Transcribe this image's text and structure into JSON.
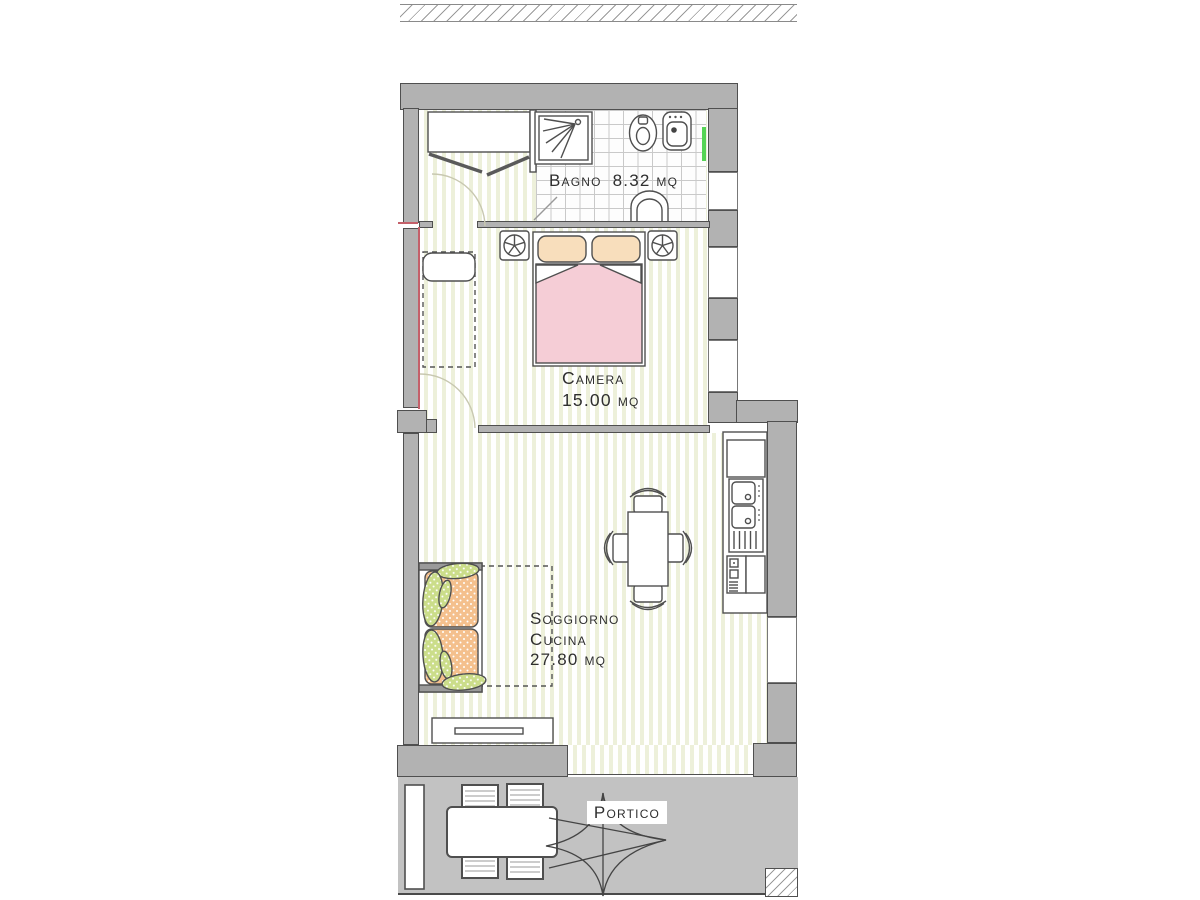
{
  "meta": {
    "drawing_type": "apartment floor plan",
    "language": "Italian"
  },
  "rooms": {
    "bathroom": {
      "label": "Bagno",
      "area": "8.32 mq"
    },
    "bedroom": {
      "label": "Camera",
      "area": "15.00 mq"
    },
    "living_kitchen": {
      "line1": "Soggiorno",
      "line2": "Cucina",
      "area": "27.80 mq"
    },
    "porch": {
      "label": "Portico"
    }
  },
  "furniture": [
    "wardrobe",
    "entry-door-swing",
    "bedroom-door-swing",
    "bathroom-door-leaf",
    "lounge-chair",
    "double-bed",
    "pillows",
    "nightstand-left",
    "nightstand-right",
    "shower",
    "toilet",
    "bidet",
    "washbasin",
    "sofa",
    "rug",
    "dining-table",
    "dining-chairs",
    "kitchen-counter",
    "kitchen-sink",
    "kitchen-appliances",
    "tv-cabinet",
    "porch-pillar",
    "porch-table",
    "porch-chairs",
    "compass-star",
    "hatched-pillar",
    "hatched-boundary-strip"
  ],
  "colors": {
    "wall": "#b2b2b2",
    "porch_floor": "#c2c2c2",
    "floor_stripe": "#edf0da",
    "outline": "#4f4f4f",
    "bed_blanket": "#f5cdd6",
    "bed_pillow": "#f8debc",
    "sofa_cushion": "#f4c08d",
    "sofa_pillow": "#cbdd8a",
    "brick_line": "#c9c9c9",
    "window_marker": "#55d455",
    "annotation_red": "#c4606a"
  }
}
